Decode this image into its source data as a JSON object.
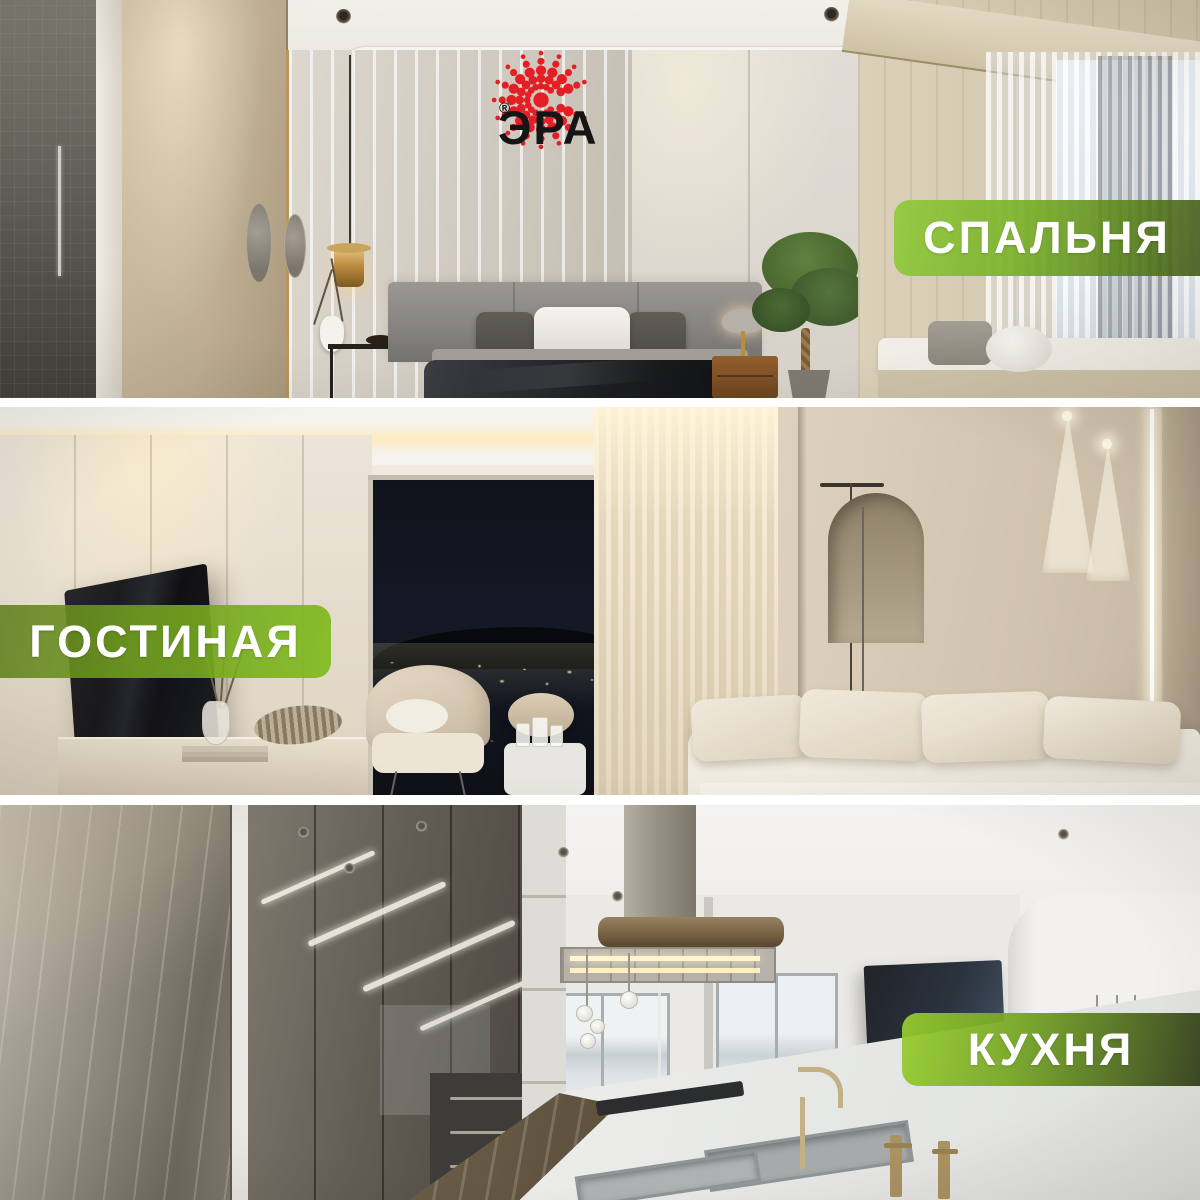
{
  "brand": {
    "logo_text": "ЭРА",
    "registered_mark": "®"
  },
  "sections": [
    {
      "id": "bedroom",
      "label": "СПАЛЬНЯ",
      "badge_position": "right",
      "scene": "bedroom interior"
    },
    {
      "id": "living-room",
      "label": "ГОСТИНАЯ",
      "badge_position": "left",
      "scene": "living room interior at night"
    },
    {
      "id": "kitchen",
      "label": "КУХНЯ",
      "badge_position": "right",
      "scene": "kitchen interior"
    }
  ],
  "colors": {
    "logo_red": "#e31e24",
    "ink": "#151515",
    "badge_text": "#ffffff",
    "green_light": "#8ec83d",
    "green_mid": "#74a824",
    "green_dark": "#47621c",
    "divider_white": "#ffffff"
  }
}
